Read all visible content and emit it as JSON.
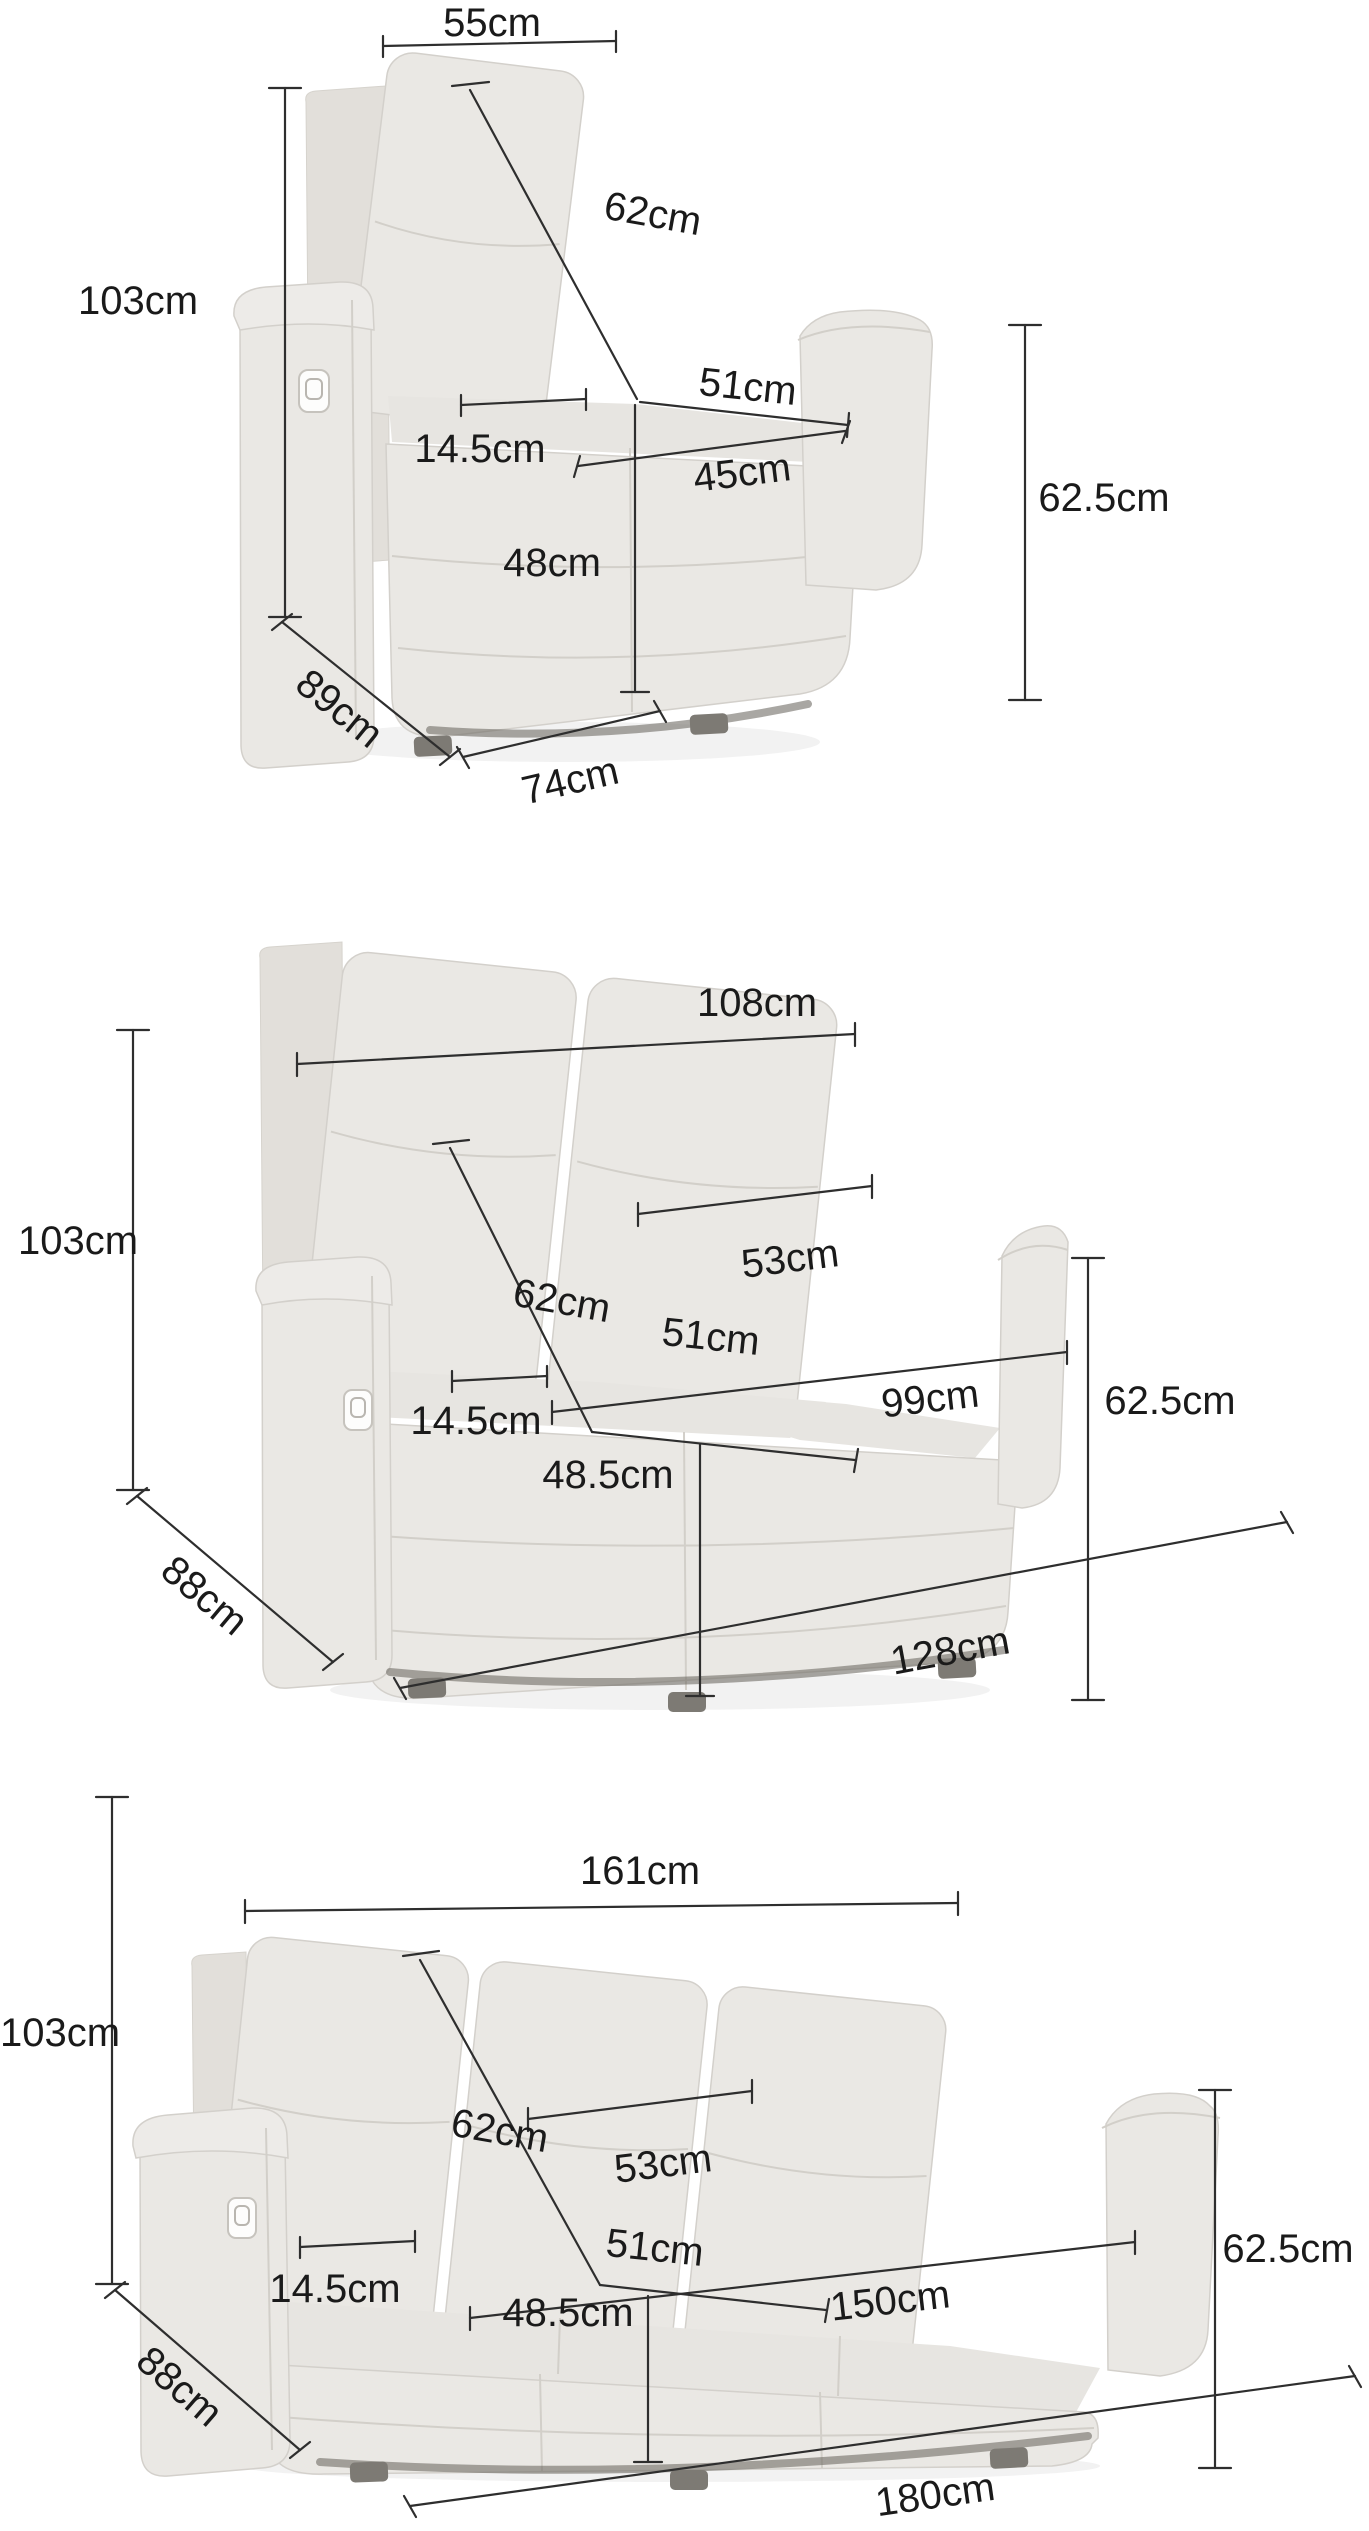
{
  "unit": "cm",
  "colors": {
    "fabric": "#eae8e4",
    "fabric_shadowed": "#e2dfda",
    "dimension_line": "#2e2e2e",
    "label_text": "#1a1a1a",
    "background": "#ffffff"
  },
  "sections": [
    {
      "name": "armchair-recliner",
      "dims": {
        "back_width": "55cm",
        "height": "103cm",
        "backrest_height": "62cm",
        "seat_depth": "51cm",
        "armrest_width": "14.5cm",
        "seat_width": "45cm",
        "seat_height": "48cm",
        "arm_height": "62.5cm",
        "depth": "89cm",
        "front_width": "74cm"
      }
    },
    {
      "name": "2-seater-recliner-sofa",
      "dims": {
        "back_width": "108cm",
        "headrest_width": "53cm",
        "height": "103cm",
        "backrest_height": "62cm",
        "seat_depth": "51cm",
        "seat_width": "99cm",
        "armrest_width": "14.5cm",
        "seat_height": "48.5cm",
        "arm_height": "62.5cm",
        "depth": "88cm",
        "front_width": "128cm"
      }
    },
    {
      "name": "3-seater-recliner-sofa",
      "dims": {
        "back_width": "161cm",
        "headrest_width": "53cm",
        "height": "103cm",
        "backrest_height": "62cm",
        "seat_depth": "51cm",
        "seat_width": "150cm",
        "armrest_width": "14.5cm",
        "seat_height": "48.5cm",
        "arm_height": "62.5cm",
        "depth": "88cm",
        "front_width": "180cm"
      }
    }
  ]
}
